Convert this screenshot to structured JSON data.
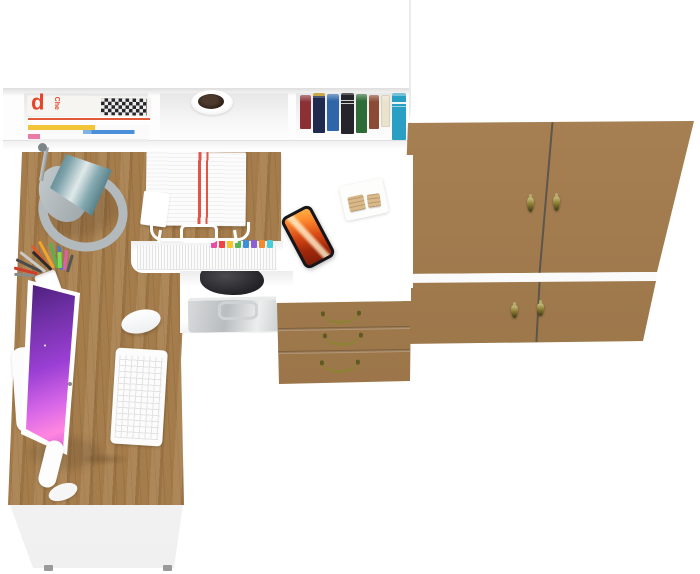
{
  "scene": {
    "description_objects": [
      "white hutch shelf with magazines, plant pot and books",
      "white and oak corner desk",
      "desk lamp",
      "paper tray with documents",
      "pen cup with pens",
      "iMac-style monitor with purple wallpaper",
      "white keyboard",
      "white mouse",
      "smartphone with flame wallpaper",
      "wooden memo blocks on notepad",
      "file niche with colorful index tabs",
      "shelf with dark bag and metal briefcase",
      "oak three-drawer pedestal with brass bow handles",
      "oak two-door wardrobe with brass drop pulls"
    ]
  },
  "texts": {
    "magazine_letter": "d",
    "magazine_spine": "Che"
  },
  "colors": {
    "wood-base": "#a57c4b",
    "wood-dark": "#7c5a33",
    "wood-light": "#c59e6b",
    "panel-white": "#ffffff",
    "panel-edge": "#e9e9e9",
    "brass": "#8f8136",
    "brass-dark": "#5f5a22",
    "lamp-teal-dark": "#3f6d77",
    "lamp-teal-light": "#e0e9ea",
    "lamp-gray": "#b2babe",
    "screen-purple-deep": "#3c1566",
    "screen-purple": "#9b3fd4",
    "screen-magenta": "#d867e8",
    "screen-pink": "#ff86e0",
    "flame": "#d84a15",
    "flame-dark": "#7a1c08",
    "flame-light": "#ffb347",
    "magazine-red": "#e8442a",
    "book-1": "#8c3036",
    "book-2": "#1f2a4e",
    "book-3": "#2f66a8",
    "book-4": "#25242a",
    "book-5": "#2e6b36",
    "book-6": "#8a4a33",
    "book-7": "#e9e2cc",
    "book-8": "#2a9fc4",
    "tab-1": "#e84fa0",
    "tab-2": "#f04444",
    "tab-3": "#f4c52c",
    "tab-4": "#58b557",
    "tab-5": "#3f8fd6",
    "tab-6": "#8e5fd0",
    "tab-7": "#f08a2c",
    "tab-8": "#4ccbd8"
  }
}
